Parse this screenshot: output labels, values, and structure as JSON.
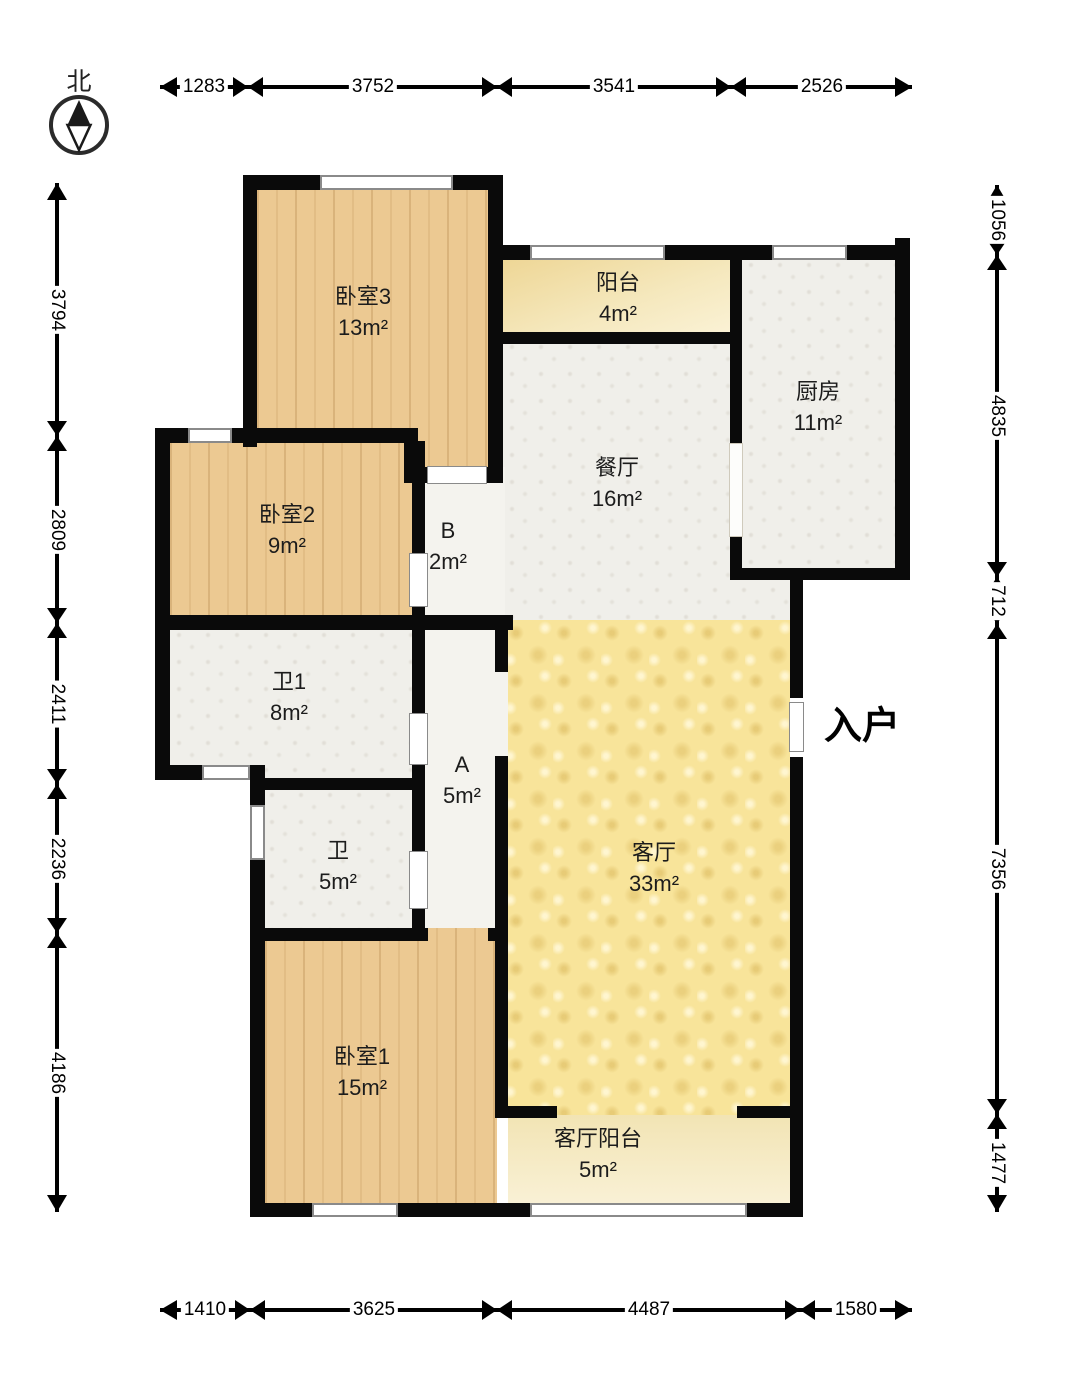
{
  "compass": {
    "label": "北"
  },
  "entrance": {
    "label": "入户"
  },
  "rooms": [
    {
      "id": "bedroom3",
      "name": "卧室3",
      "area": "13m²"
    },
    {
      "id": "balcony",
      "name": "阳台",
      "area": "4m²"
    },
    {
      "id": "kitchen",
      "name": "厨房",
      "area": "11m²"
    },
    {
      "id": "dining",
      "name": "餐厅",
      "area": "16m²"
    },
    {
      "id": "bedroom2",
      "name": "卧室2",
      "area": "9m²"
    },
    {
      "id": "hall-b",
      "name": "B",
      "area": "2m²"
    },
    {
      "id": "bath1",
      "name": "卫1",
      "area": "8m²"
    },
    {
      "id": "bath",
      "name": "卫",
      "area": "5m²"
    },
    {
      "id": "hall-a",
      "name": "A",
      "area": "5m²"
    },
    {
      "id": "living",
      "name": "客厅",
      "area": "33m²"
    },
    {
      "id": "bedroom1",
      "name": "卧室1",
      "area": "15m²"
    },
    {
      "id": "living-balcony",
      "name": "客厅阳台",
      "area": "5m²"
    }
  ],
  "dimensions": {
    "top": [
      "1283",
      "3752",
      "3541",
      "2526"
    ],
    "bottom": [
      "1410",
      "3625",
      "4487",
      "1580"
    ],
    "left": [
      "3794",
      "2809",
      "2411",
      "2236",
      "4186"
    ],
    "right": [
      "1056",
      "4835",
      "712",
      "7356",
      "1477"
    ]
  },
  "colors": {
    "wall": "#0a0a0a",
    "wood_floor": "#ecc992",
    "living_floor": "#f8e49a",
    "balcony_floor": "#f3e2ab",
    "tile_floor": "#f0efea",
    "text": "#1a1a1a"
  }
}
